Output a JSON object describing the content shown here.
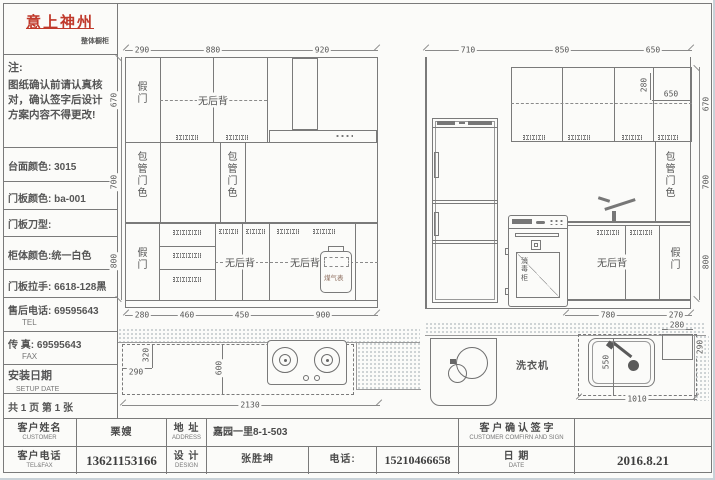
{
  "logo": {
    "title": "意上神州",
    "subtitle": "整体橱柜"
  },
  "notes": {
    "title": "注:",
    "body": "图纸确认前请认真核对，确认签字后设计方案内容不得更改!"
  },
  "specs": {
    "countertop": "台面颜色: 3015",
    "door_color": "门板颜色: ba-001",
    "door_profile": "门板刀型:",
    "cabinet_color": "柜体颜色:统一白色",
    "handle": "门板拉手: 6618-128黑",
    "service_tel": "售后电话: 69595643",
    "service_tel_sub": "TEL",
    "fax": "传  真: 69595643",
    "fax_sub": "FAX",
    "setup": "安装日期",
    "setup_sub": "SETUP DATE",
    "pages": "共 1 页 第 1 张"
  },
  "left_elevation": {
    "top_dims": [
      "290",
      "880",
      "920"
    ],
    "bottom_dims": [
      "280",
      "460",
      "450",
      "900"
    ],
    "side_dims": [
      "670",
      "700",
      "800"
    ],
    "labels": {
      "fake_door": "假门",
      "no_back": "无后背",
      "pipe_box": "包管门色",
      "gas_meter": "煤气表"
    }
  },
  "right_elevation": {
    "top_dims": [
      "710",
      "850",
      "650"
    ],
    "bottom_dims": [
      "780",
      "270"
    ],
    "side_dims": [
      "670",
      "700",
      "800"
    ],
    "corner_dims": {
      "vertical": "280",
      "horizontal": "650"
    },
    "labels": {
      "no_back": "无后背",
      "fake_door": "假门",
      "pipe_box": "包管门色",
      "sterilizer": "消毒柜"
    }
  },
  "left_plan": {
    "dims": {
      "corner_w": "290",
      "corner_h": "320",
      "depth": "600",
      "total": "2130"
    }
  },
  "right_plan": {
    "labels": {
      "washer": "洗衣机"
    },
    "dims": {
      "sink": "550",
      "duct_w": "280",
      "duct_h": "290",
      "total": "1010"
    }
  },
  "title_block": {
    "customer_label": "客户姓名",
    "customer_sub": "CUSTOMER",
    "customer_value": "栗嫂",
    "address_label": "地 址",
    "address_sub": "ADDRESS",
    "address_value": "嘉园一里8-1-503",
    "confirm_label": "客 户 确 认 签 字",
    "confirm_sub": "CUSTOMER COMFIRN AND SIGN",
    "tel_label": "客户电话",
    "tel_sub": "TEL&FAX",
    "tel_value": "13621153166",
    "design_label": "设 计",
    "design_sub": "DESIGN",
    "design_value": "张胜坤",
    "phone_label": "电话:",
    "phone_value": "15210466658",
    "date_label": "日 期",
    "date_sub": "DATE",
    "date_value": "2016.8.21"
  }
}
